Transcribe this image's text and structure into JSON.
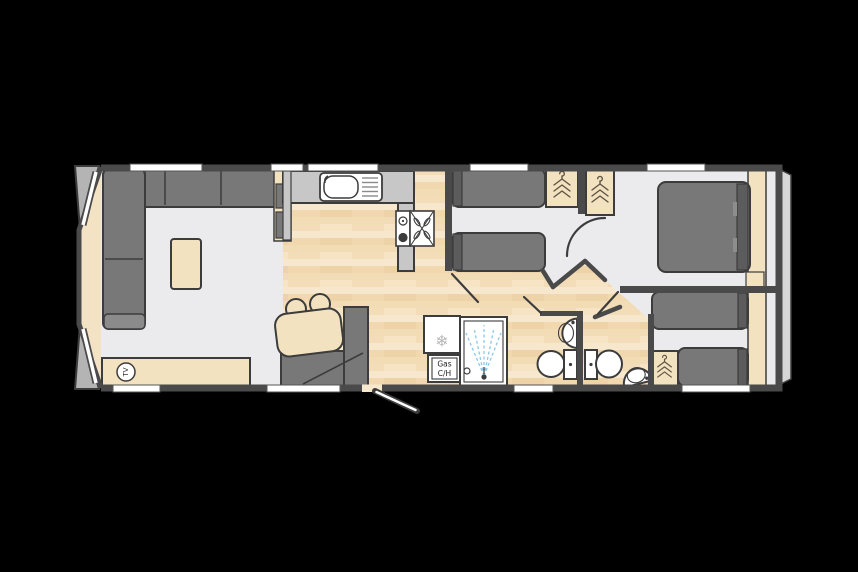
{
  "plan": {
    "labels": {
      "tv": "TV",
      "gas_line1": "Gas",
      "gas_line2": "C/H"
    },
    "icons": {
      "fridge_snowflake": "❄",
      "wardrobe_hanger": "stacked-hangers-shape",
      "cooker_fan": "x-propeller-shape",
      "shower_spray": "blue-dashed-spray"
    },
    "colors": {
      "wall": "#4a4a4a",
      "line": "#3c3c3c",
      "floor": "#ebebed",
      "wood-a": "#f3ddb8",
      "wood-b": "#f7e8cd",
      "wood-c": "#eed3a9",
      "wood-d": "#f2dcb6",
      "wood-e": "#f6e4c4",
      "wood-f": "#f1d8ae",
      "counter": "#c7c7c7",
      "dark-furniture": "#787878",
      "headboard": "#5c5c5c",
      "beige": "#f3e2c0",
      "bay-beige": "#f3e3c4",
      "fixture-white": "#ffffff",
      "window": "#ffffff",
      "spray": "#8cc8ea",
      "band": "#d6d6d6",
      "triangle": "#b4b4b4",
      "outside": "#000000",
      "hanger": "#5f5545"
    }
  }
}
